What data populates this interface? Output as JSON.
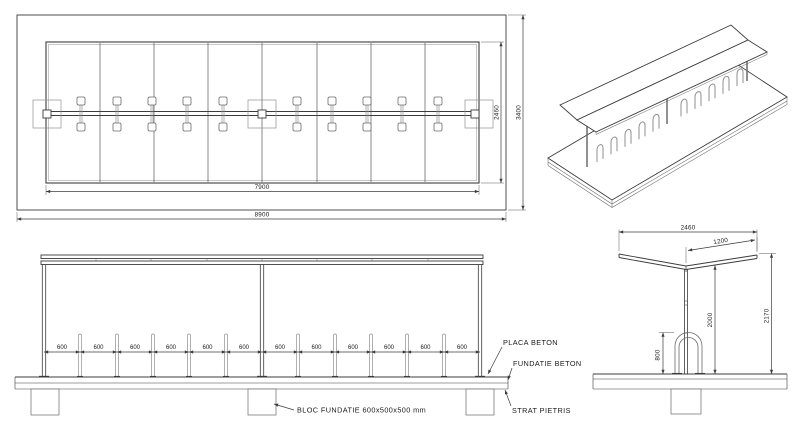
{
  "plan_view": {
    "dim_roof_length": "7900",
    "dim_slab_length": "8900",
    "dim_roof_width": "2460",
    "dim_slab_width": "3400"
  },
  "front_elevation": {
    "dim_spacing": "600",
    "labels": {
      "placa_beton": "PLACA BETON",
      "fundatie_beton": "FUNDATIE BETON",
      "strat_pietris": "STRAT PIETRIS",
      "bloc_fundatie": "BLOC FUNDATIE 600x500x500 mm"
    }
  },
  "side_elevation": {
    "dim_width": "2460",
    "dim_roof_half": "1200",
    "dim_clear_height": "2000",
    "dim_total_height": "2170",
    "dim_rack_height": "800"
  },
  "colors": {
    "line": "#3c3c3c",
    "line_light": "#8f8f8f",
    "text": "#1a1a1a",
    "background": "#ffffff"
  }
}
